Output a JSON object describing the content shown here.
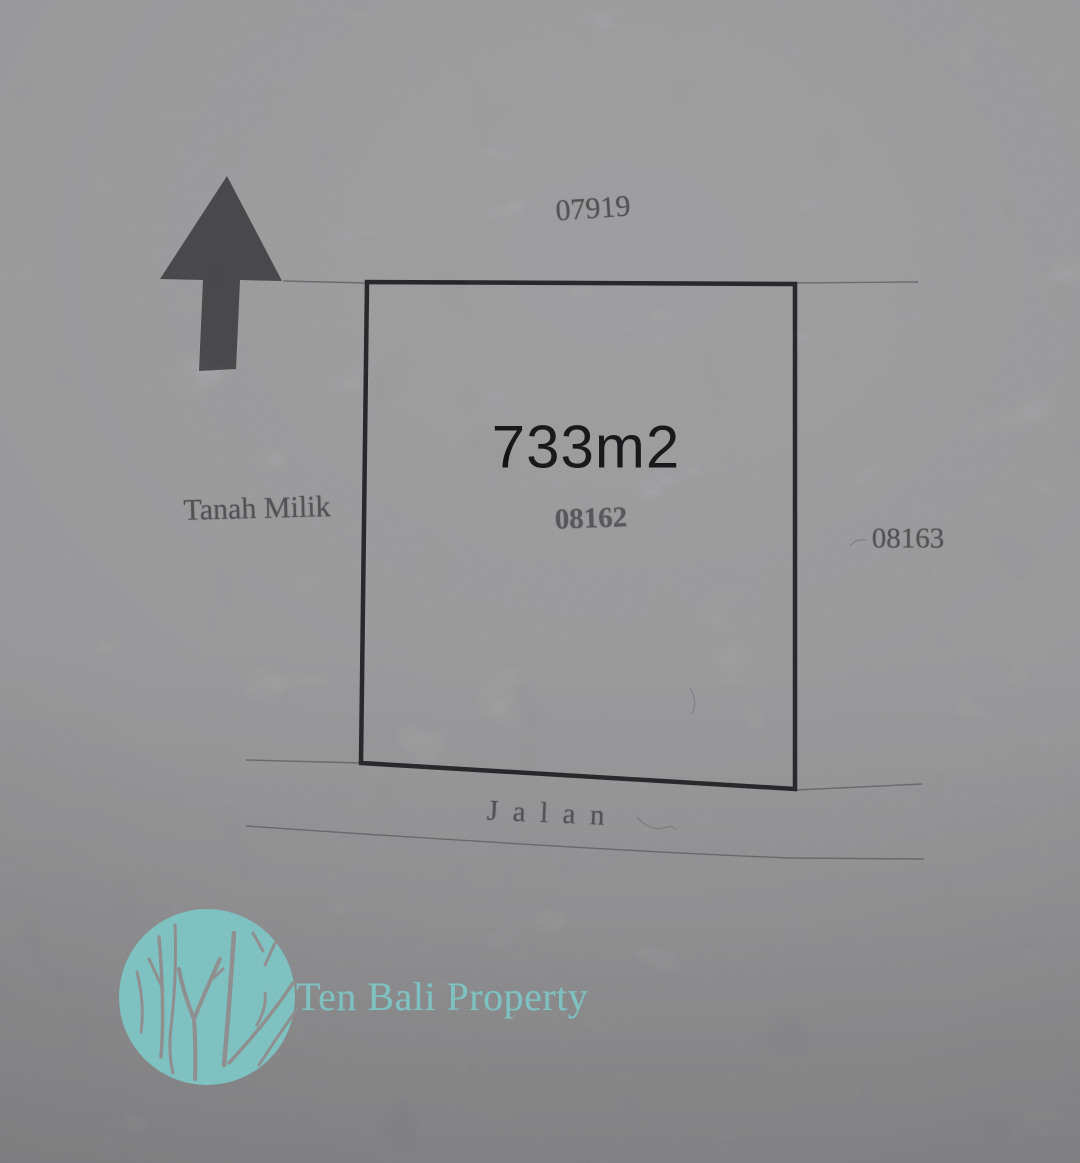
{
  "survey": {
    "north_parcel_id": "07919",
    "parcel": {
      "area_label": "733m2",
      "parcel_id": "08162"
    },
    "west_label": "Tanah Milik",
    "east_parcel_id": "08163",
    "road_label": "Jalan"
  },
  "branding": {
    "company_name": "Ten Bali Property"
  },
  "colors": {
    "paper_top": "#b6b6b8",
    "paper_mid": "#adadaf",
    "paper_bottom": "#98989b",
    "boundary_ink": "#202024",
    "faint_ink": "#54545a",
    "area_ink": "#0b0b0d",
    "arrow_gray": "#48484b",
    "brand_teal": "#8de2e2",
    "logo_branch_gray": "#a1a1a3"
  }
}
